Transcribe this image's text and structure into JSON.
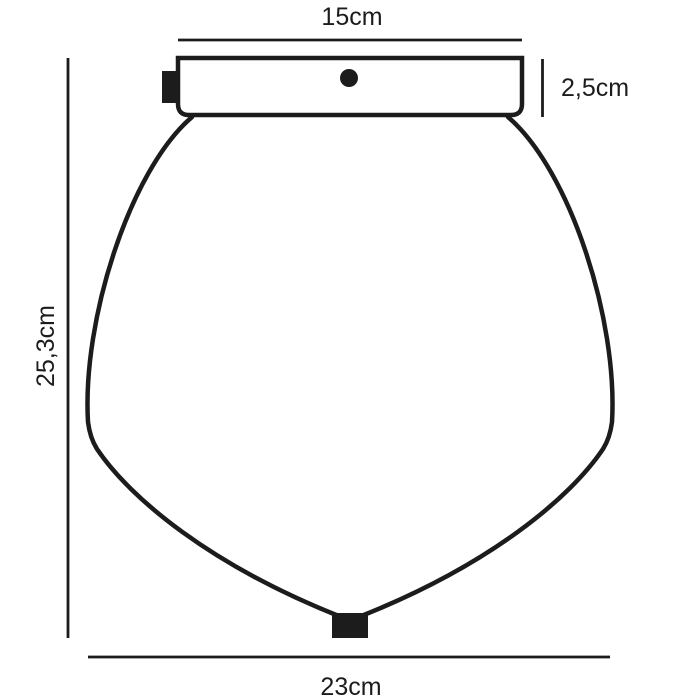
{
  "diagram": {
    "kind": "product-dimension-drawing",
    "labels": {
      "top_width": "15cm",
      "canopy_height": "2,5cm",
      "total_height": "25,3cm",
      "shade_width": "23cm"
    },
    "colors": {
      "line": "#1c1c1c",
      "background": "#ffffff"
    }
  }
}
